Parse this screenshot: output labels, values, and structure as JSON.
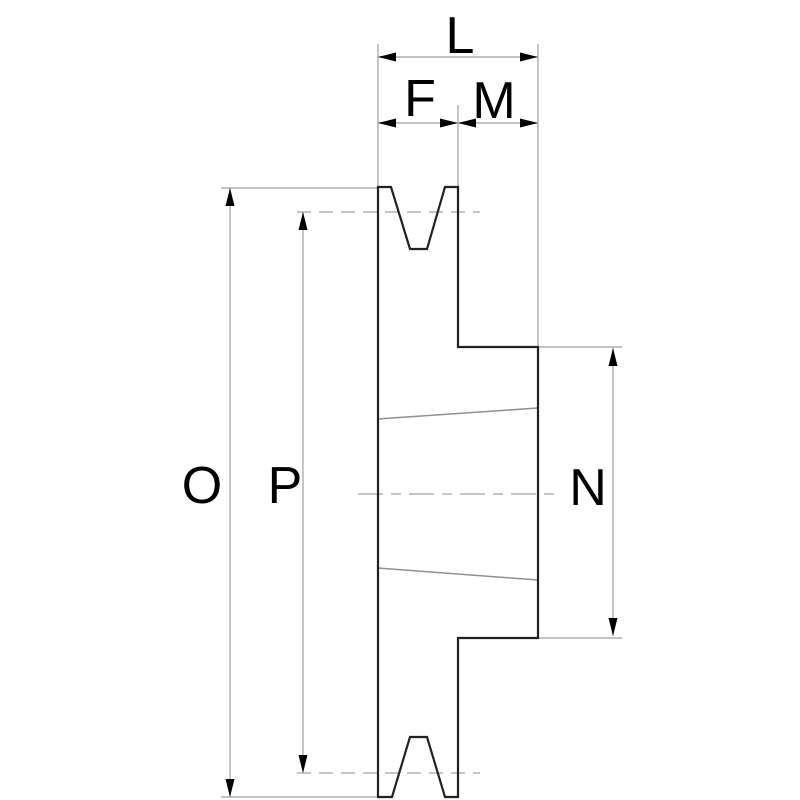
{
  "drawing": {
    "labels": {
      "l": "L",
      "f": "F",
      "m": "M",
      "o": "O",
      "p": "P",
      "n": "N"
    },
    "colors": {
      "background": "#ffffff",
      "outline": "#222222",
      "thin_line": "#aeaeae",
      "dash_line": "#b4b4b4",
      "taper_line": "#919191",
      "arrow": "#000000",
      "label": "#000000"
    }
  }
}
